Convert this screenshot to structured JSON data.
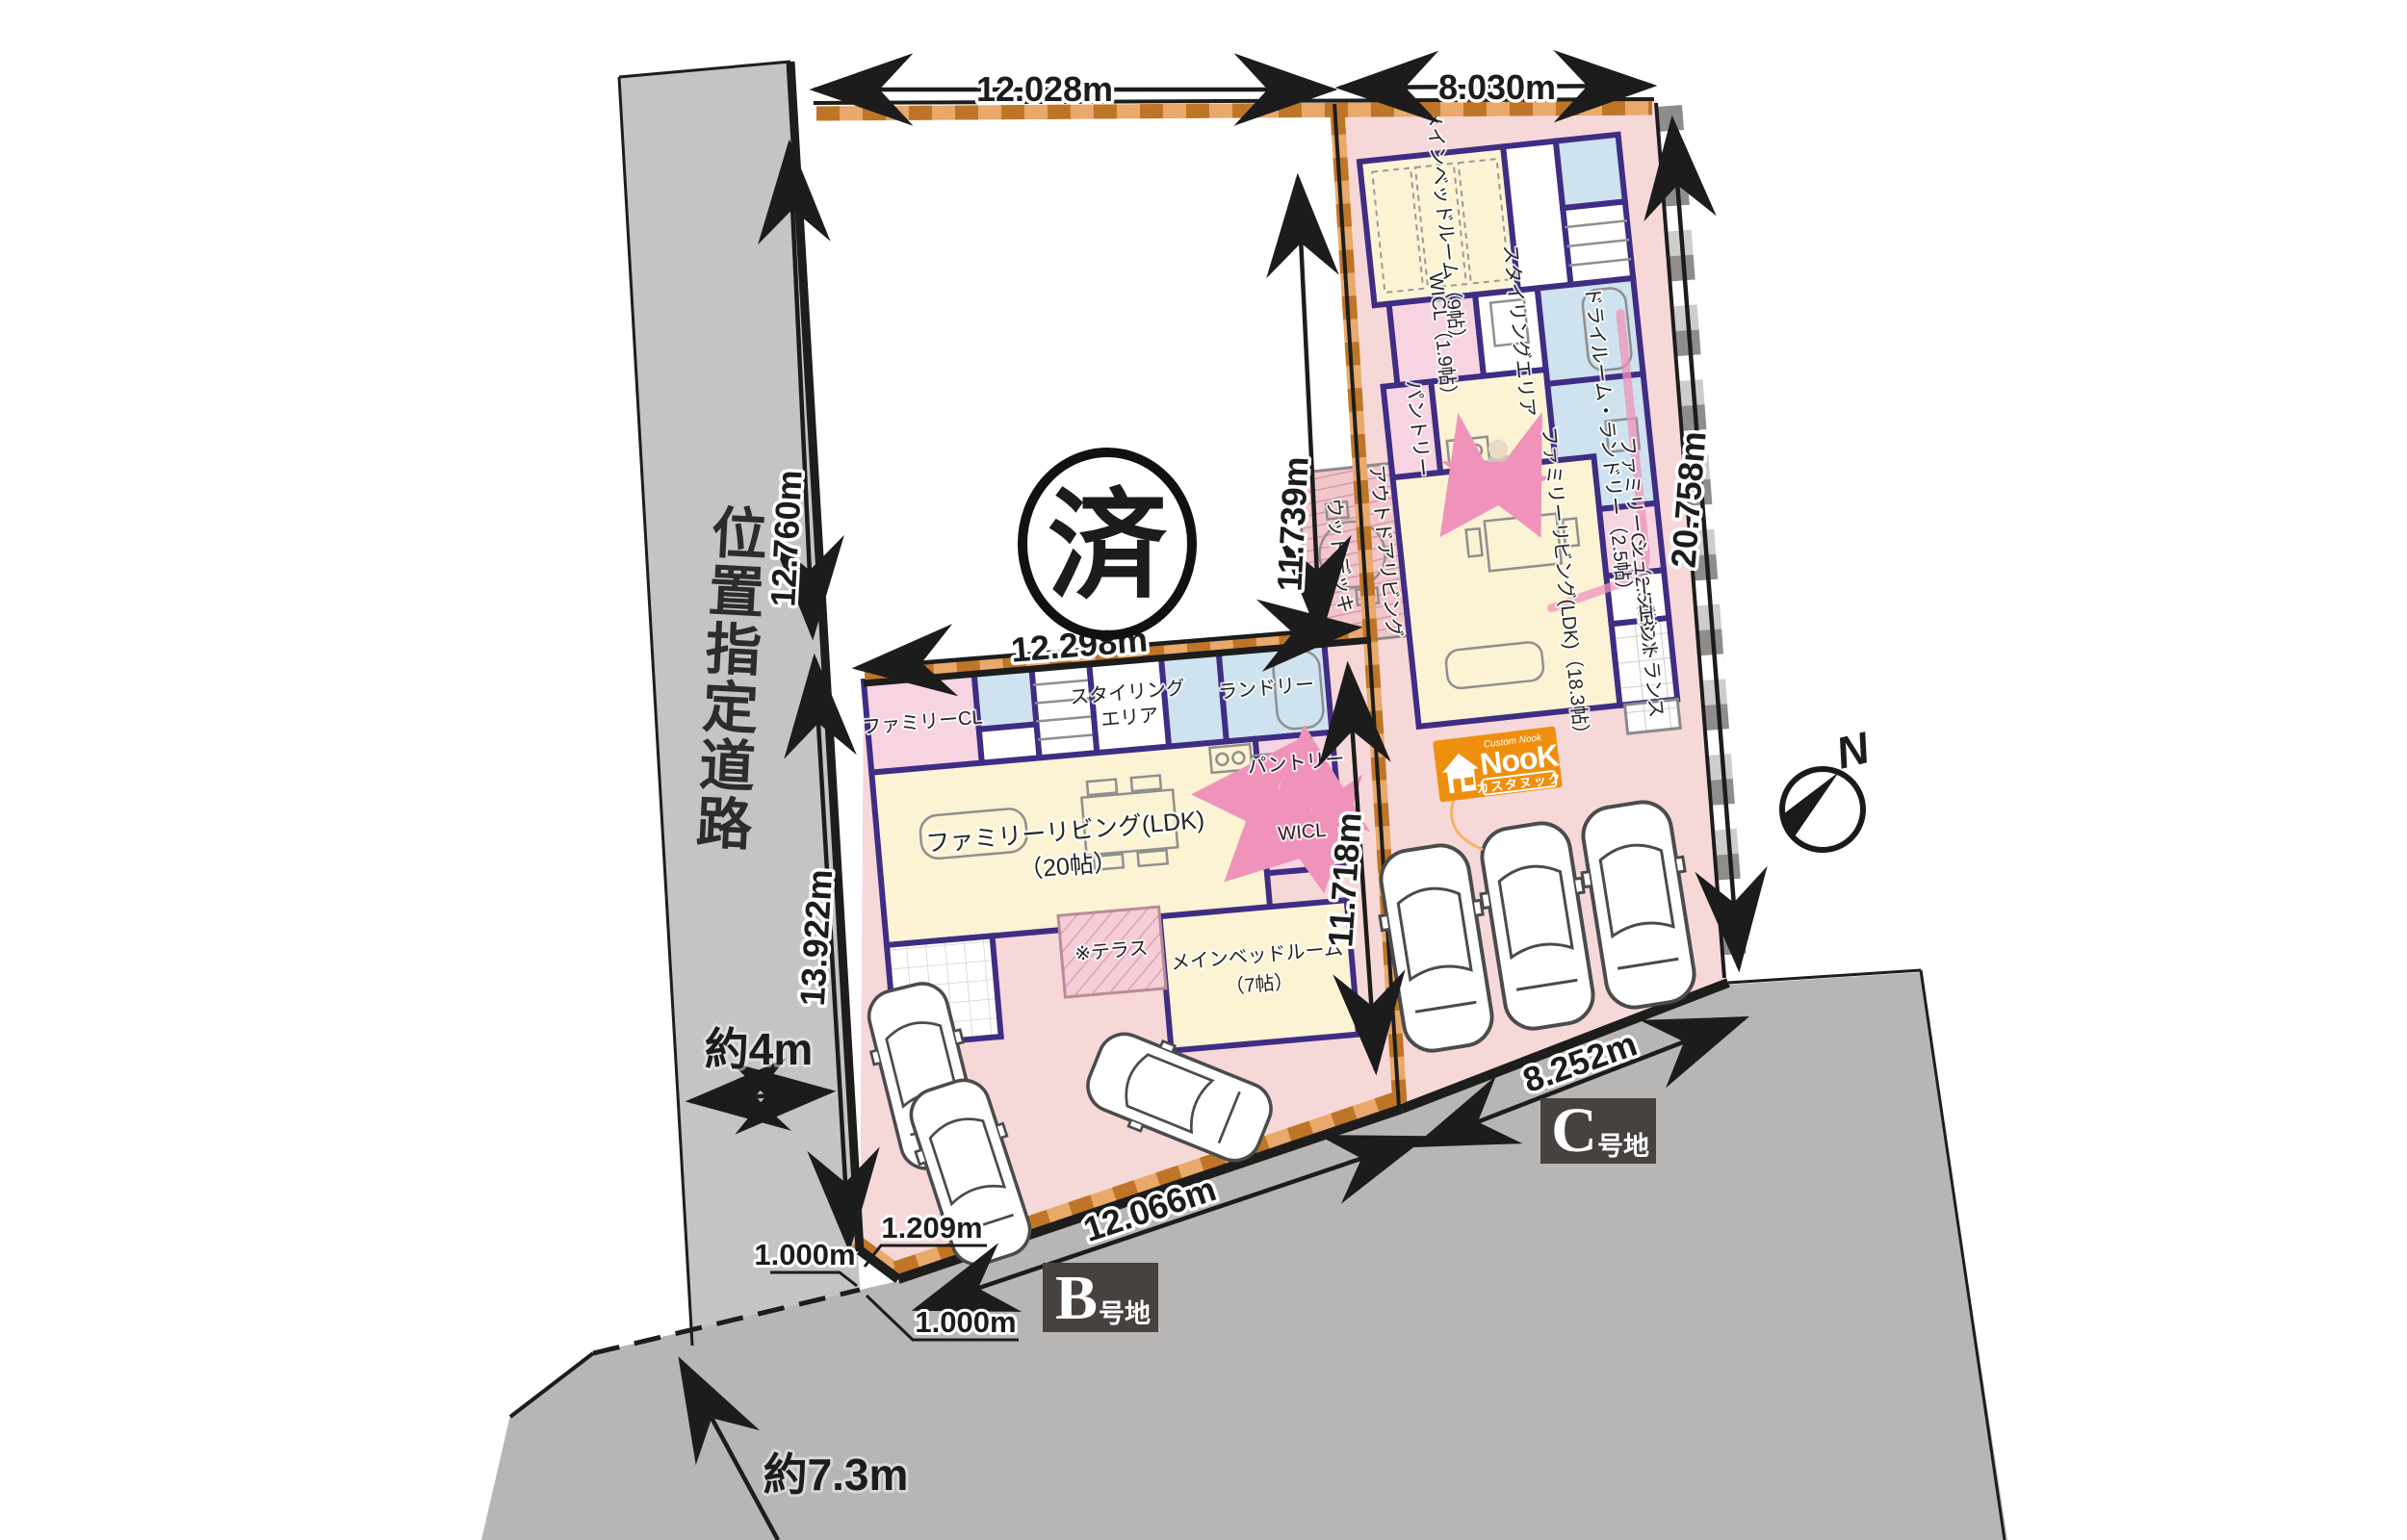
{
  "site": {
    "road_label": "位置指定道路",
    "sold_stamp": "済",
    "north_label": "N",
    "colors": {
      "lot_pink": "#f7d8d8",
      "road_gray": "#c6c4c2",
      "south_gray": "#b8b6b4",
      "setback_orange_dark": "#bf7527",
      "setback_orange_light": "#e8a96b",
      "wall_purple": "#3f2d84",
      "flow_arrow_pink": "#ef93ba",
      "badge_bg": "#474240",
      "logo_orange": "#ef8f0e"
    }
  },
  "lots": {
    "b": {
      "letter": "B",
      "suffix": "号地"
    },
    "c": {
      "letter": "C",
      "suffix": "号地"
    }
  },
  "dimensions": {
    "top_left": "12.028m",
    "top_right": "8.030m",
    "road_upper": "12.760m",
    "lot_a_right": "11.739m",
    "c_right": "20.758m",
    "b_top": "12.298m",
    "road_lower": "13.922m",
    "b_c_boundary": "11.718m",
    "c_bottom": "8.252m",
    "b_bottom": "12.066m",
    "b_corner_cut": "1.209m",
    "corner_offset_left": "1.000m",
    "corner_offset_bottom": "1.000m",
    "road_width": "約4m",
    "south_road_width": "約7.3m"
  },
  "logo": {
    "small_text": "Custom Nook",
    "brand": "NooK",
    "subtitle": "カスタヌック"
  },
  "plan_b": {
    "family_cl": "ファミリーCL",
    "styling_line1": "スタイリング",
    "styling_line2": "エリア",
    "laundry": "ランドリー",
    "ldk_line1": "ファミリーリビング(LDK)",
    "ldk_line2": "（20帖）",
    "pantry": "パントリー",
    "wicl": "WICL",
    "bedroom_line1": "メインベッドルーム",
    "bedroom_line2": "（7帖）",
    "terrace": "※テラス"
  },
  "plan_c": {
    "bedroom": "メインベッドルーム（9帖）",
    "wicl": "WICL（1.9帖）",
    "styling": "スタイリングエリア",
    "dry_laundry": "ドライルーム・ランドリー（2.5帖）",
    "pantry": "パントリー",
    "ldk": "ファミリーリビング(LDK)（18.3帖）",
    "family_cl": "ファミリーCL（2.5帖）",
    "shoes_box": "シューズBOX",
    "entrance": "エントランス",
    "wood_deck": "ウッドデッキ",
    "outdoor_living": "アウトドアリビング"
  }
}
